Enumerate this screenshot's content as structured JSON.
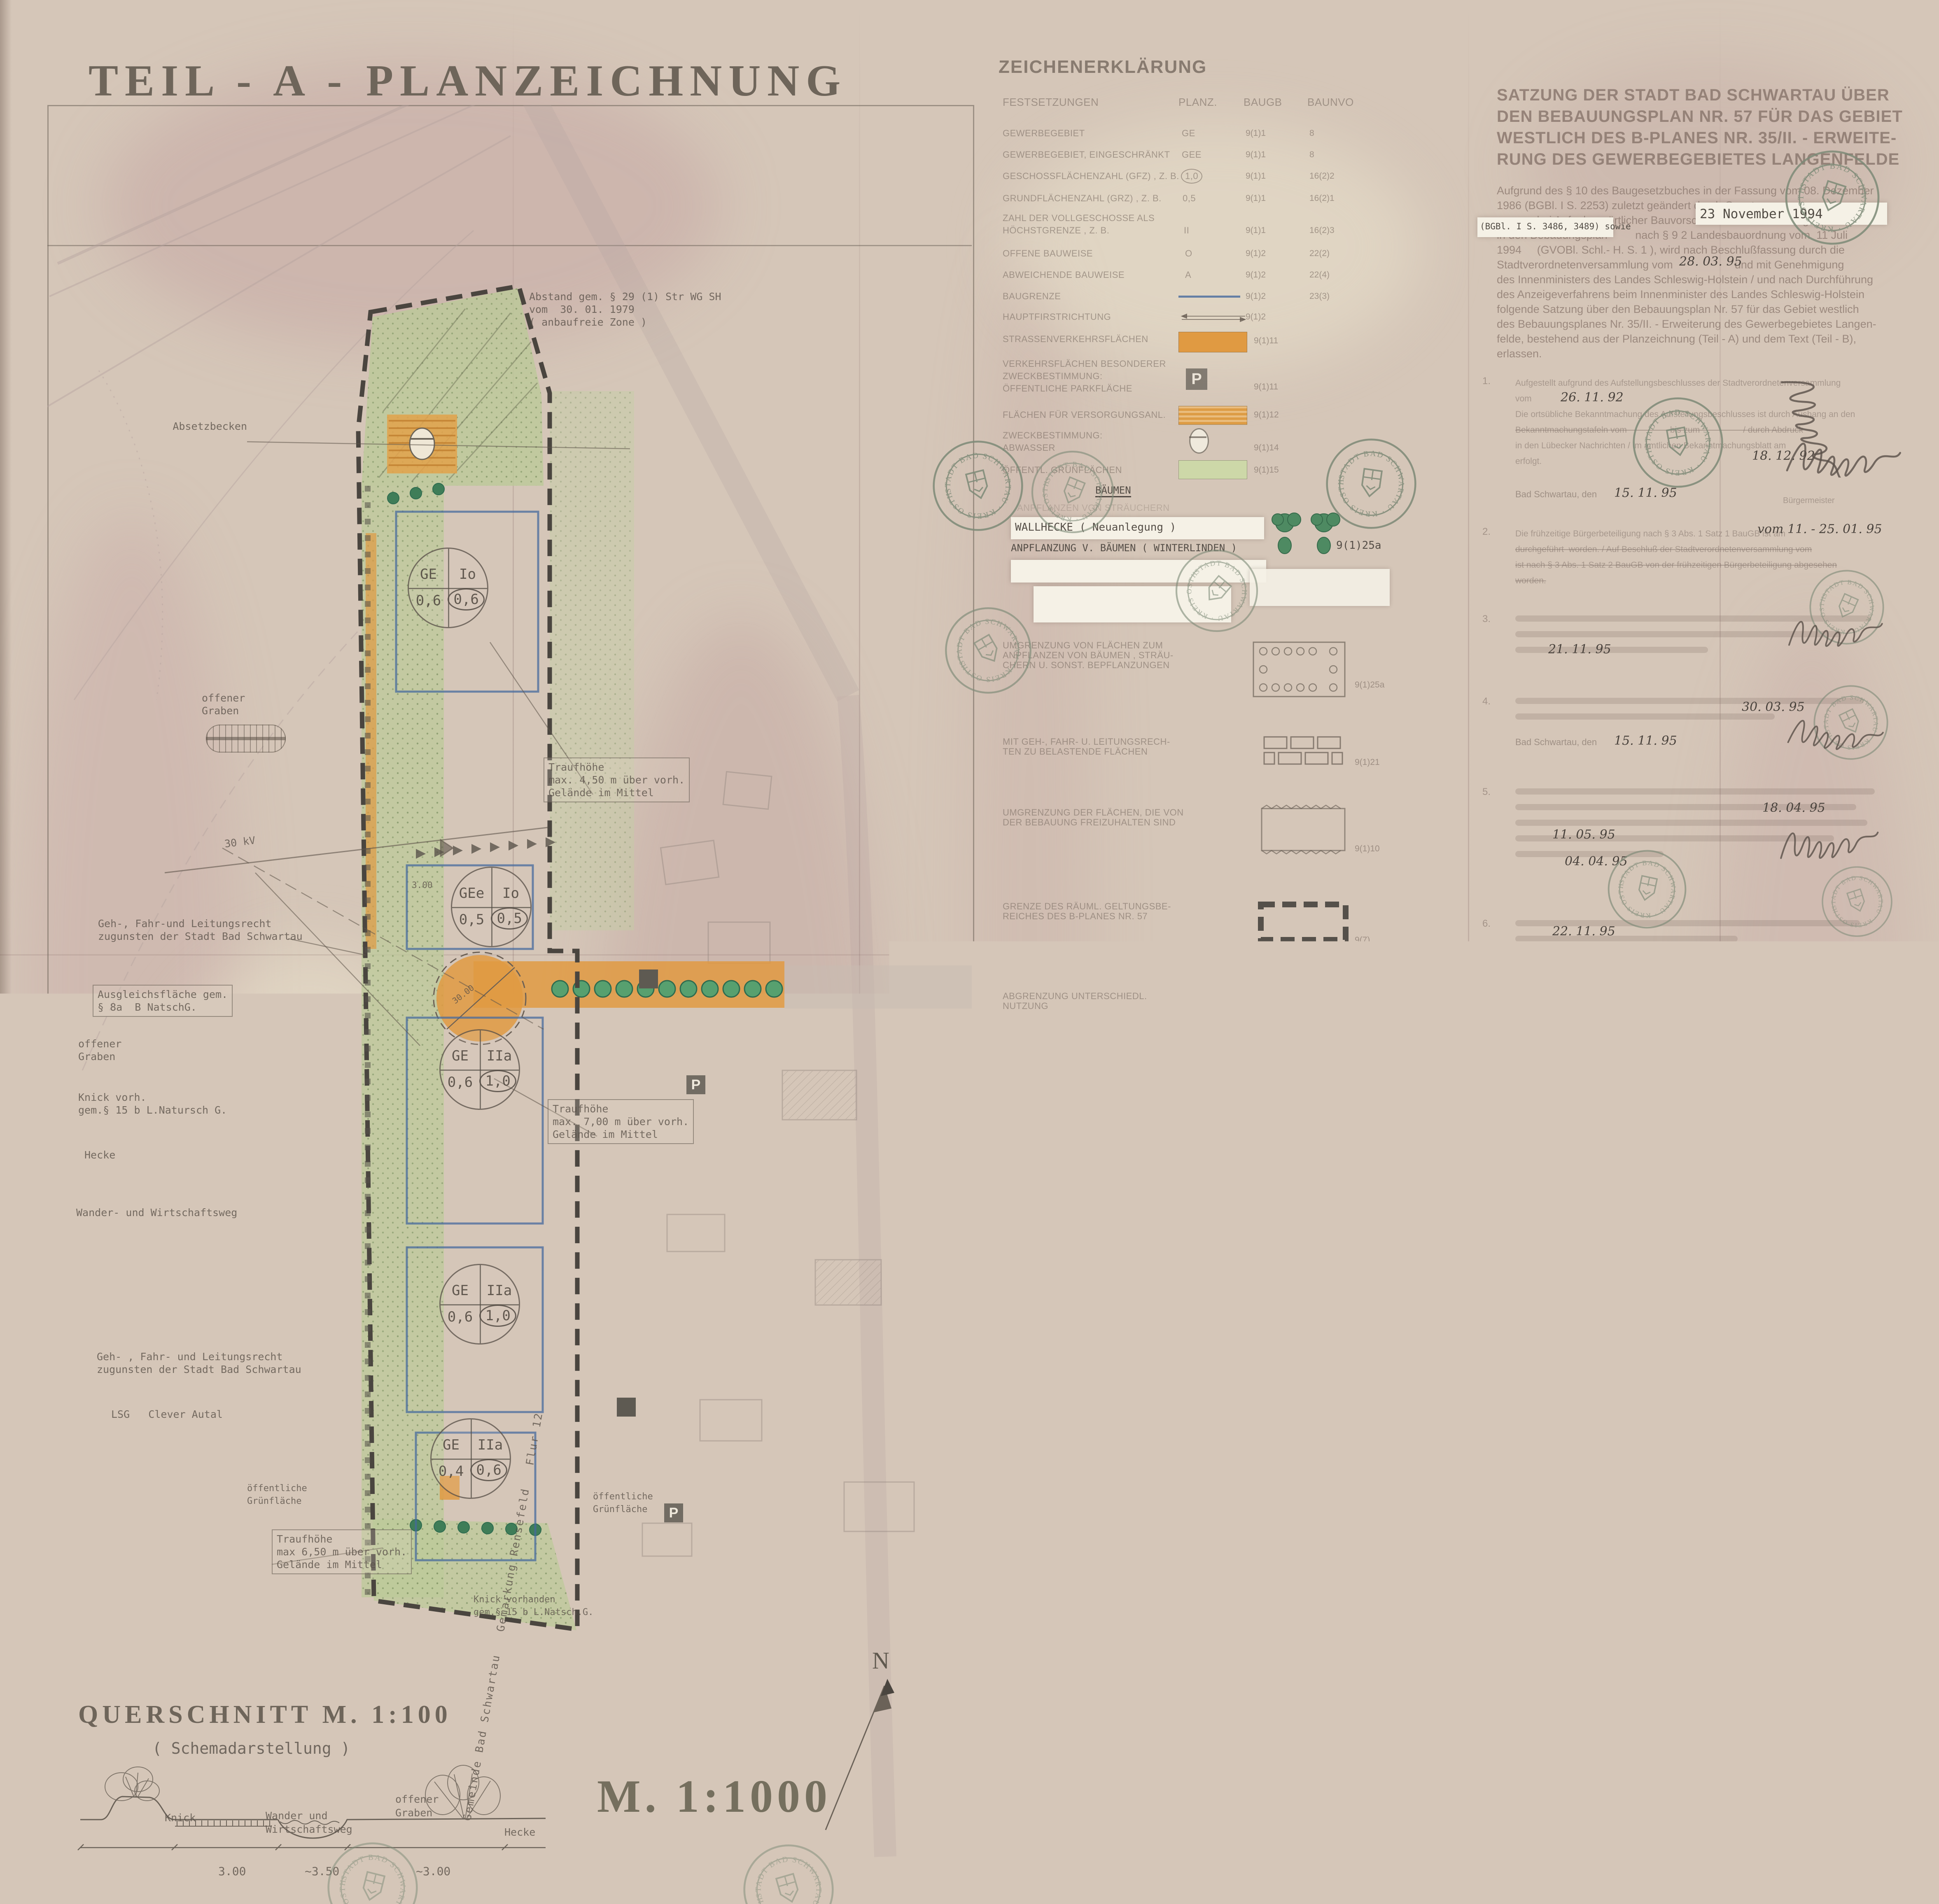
{
  "colors": {
    "paper": "#d5c6b8",
    "orange": "#e09a42",
    "green": "#b9c795",
    "blue": "#46699e",
    "dark": "#4a453f",
    "stamp_green": "#7d8a77"
  },
  "page": {
    "title": "TEIL - A - PLANZEICHNUNG"
  },
  "stamp": {
    "ring": "STADT BAD SCHWARTAU · KREIS OSTHOLSTEIN ·"
  },
  "legend": {
    "title": "ZEICHENERKLÄRUNG",
    "col_headers": {
      "festsetzungen": "FESTSETZUNGEN",
      "planz": "PLANZ.",
      "baugb": "BAUGB",
      "baunvo": "BAUNVO"
    },
    "rows": [
      {
        "label": "GEWERBEGEBIET",
        "planz": "GE",
        "baugb": "9(1)1",
        "baunvo": "8"
      },
      {
        "label": "GEWERBEGEBIET, EINGESCHRÄNKT",
        "planz": "GEe",
        "baugb": "9(1)1",
        "baunvo": "8"
      },
      {
        "label": "GESCHOSSFLÄCHENZAHL (GFZ) , z. B.",
        "planz": "1,0",
        "baugb": "9(1)1",
        "baunvo": "16(2)2"
      },
      {
        "label": "GRUNDFLÄCHENZAHL (GRZ) , z. B.",
        "planz": "0,5",
        "baugb": "9(1)1",
        "baunvo": "16(2)1"
      },
      {
        "l1": "ZAHL DER VOLLGESCHOSSE ALS",
        "l2": "HÖCHSTGRENZE , z. B.",
        "planz": "II",
        "baugb": "9(1)1",
        "baunvo": "16(2)3"
      },
      {
        "label": "OFFENE BAUWEISE",
        "planz": "o",
        "baugb": "9(1)2",
        "baunvo": "22(2)"
      },
      {
        "label": "ABWEICHENDE BAUWEISE",
        "planz": "a",
        "baugb": "9(1)2",
        "baunvo": "22(4)"
      },
      {
        "label": "BAUGRENZE",
        "baugb": "9(1)2",
        "baunvo": "23(3)"
      },
      {
        "label": "HAUPTFIRSTRICHTUNG",
        "baugb": "9(1)2",
        "baunvo": ""
      },
      {
        "label": "STRASSENVERKEHRSFLÄCHEN",
        "baugb": "9(1)11",
        "baunvo": ""
      },
      {
        "l1": "VERKEHRSFLÄCHEN BESONDERER",
        "l2": "ZWECKBESTIMMUNG:",
        "l3": "ÖFFENTLICHE PARKFLÄCHE",
        "baugb": "9(1)11",
        "baunvo": ""
      },
      {
        "label": "FLÄCHEN FÜR VERSORGUNGSANL.",
        "baugb": "9(1)12",
        "baunvo": ""
      },
      {
        "l1": "ZWECKBESTIMMUNG:",
        "l2": "ABWASSER",
        "baugb": "9(1)14",
        "baunvo": ""
      },
      {
        "label": "ÖFFENTL. GRÜNFLÄCHEN",
        "baugb": "9(1)15",
        "baunvo": ""
      }
    ],
    "baeumen_note": "BÄUMEN",
    "anpflanzen_faded": "ANPFLANZEN VON STRÄUCHERN",
    "wallhecke_label": "WALLHECKE ( Neuanlegung )",
    "anpflanzung_label": "ANPFLANZUNG V. BÄUMEN ( WINTERLINDEN )",
    "wallhecke_ref": "9(1)25a",
    "umgrenzung_anpflanzen": [
      "UMGRENZUNG VON FLÄCHEN ZUM",
      "ANPFLANZEN VON BÄUMEN , STRÄU-",
      "CHERN U. SONST. BEPFLANZUNGEN"
    ],
    "umgrenzung_anpflanzen_ref": "9(1)25a",
    "geh_fahr": [
      "MIT GEH-, FAHR- U. LEITUNGSRECH-",
      "TEN ZU BELASTENDE FLÄCHEN"
    ],
    "geh_fahr_ref": "9(1)21",
    "freizuhalten": [
      "UMGRENZUNG DER FLÄCHEN, DIE VON",
      "DER BEBAUUNG FREIZUHALTEN SIND"
    ],
    "freizuhalten_ref": "9(1)10",
    "grenze": [
      "GRENZE DES RÄUML. GELTUNGSBE-",
      "REICHES DES B-PLANES NR. 57"
    ],
    "grenze_ref": "9(7)",
    "abgrenzung": [
      "ABGRENZUNG UNTERSCHIEDL.",
      "NUTZUNG"
    ],
    "abgrenzung_ref": "16(5)+1(4)",
    "massnahmen": [
      "UMGRENZUNG VON FLÄCHEN FÜR MAßNAHMEN",
      "ZUM SCHUTZ, ZUR PFLEGE UND ZUR ENTWICKLUNG",
      "VON NATUR UND LANDSCHAFT."
    ],
    "massnahmen_ref": "9(1) 20"
  },
  "darstellungen": {
    "title": "DARSTELLUNGEN OHNE NORMCHARAKTER",
    "rows": [
      "110 KV-FREILEITUNG",
      "GRABEN",
      "QUERSCHNITT",
      "VORH. GRUNDSTÜCKSGRENZEN",
      "GEPL. GRUNDSTÜCKSGRENZEN"
    ],
    "flurstueck_label": "FLURSTÜCKSBEZEICHNUNG",
    "flurstueck_value": "952/1"
  },
  "nachrichtlich": {
    "title": "NACHRICHTLICHE ÜBERNAHMEN",
    "knick": "KNICK GEM. § 15 b L.NatschG.",
    "lsg": "LSG  Clever Autal"
  },
  "teil_b": {
    "title": "TEIL - B - TEXT",
    "s1_head": "1. ART DER BAUL. NUTZUNG (§ 9 Abs. 1 Nr. 1 BauGB)",
    "s1": [
      "Gem. § 1 Abs 5 + 9 i. V. m. § 8 BauNVO sind im eingeschränkten Gewerbegebiet GEe nur",
      "zulässig:",
      "- Lagerhäuser",
      "- Lagerplätze, außer Schrottlagerplätze",
      "- Abstell- und Ausstellungsplätze sowie -räume",
      "- Stellplätze und Garagen",
      "- sonst. Nebenanlagen",
      "Baul. Anlagen mit Aufenthaltsräumen im Sinne § 2 Abs. 5 LBO sind im GEe unzulässig."
    ],
    "s1_hand": [
      "Gem. § 1 Abs. 9 BauNVO sind Einzelhandelsbetriebe im Gewerbegebiet nicht zulässig.",
      "Sie können als Ausnahme zugelassen werden, wenn sie in unmittelbaren räumlichen und",
      "betrieblichen Zusammenhang mit einen Handwerksbetrieb oder einem produzierendem bzw.",
      "verarbeitendem Gewerbebetrieb stehen. Eigenständige Einzelhandelsbetriebe sind als Ausnahme",
      "zulässig, wenn sie ausschließlich zur Deckung des tägl. Bedarfs der Bewohner und Beschäftigten",
      "des Gebietes dienen."
    ],
    "s2_head": "2. ABWEICHENDE BAUWEISE (§ 9 Abs. 1 Nr. 2 BauGB)",
    "s2": [
      "In der abweichenden Bauweise ist eine einseitige Grenzbebauung zulässig. Dabei können die",
      "Gebäude an jeweils einer benachbarten - im Plan als \"künftig\" dargestellten - Grundstücks-",
      "grenze, abweichend von der offenen Bauweise, bis zur Hälfte der jeweiligen Grundstückstiefe",
      "ohne Grenzabstand errichtet werden."
    ],
    "s3_head": "3. STELLPLÄTZE, GARAGEN + NEBENANLAGEN (§ 9 Abs. 1 Nr. 4 BauGB)",
    "s3": [
      "Oberirdische Stellplätze und Garagen sowie Nebenanlagen sind nur innerhalb der überbauba-",
      "ren Grundstücksflächen zulässig.",
      "Unterirdische Einstellplätze sind auch außerhalb dieser Flächen zulässig, sofern die EG-Decke",
      "begrünt wird."
    ],
    "s4_head": "4. NICHT-ÜBERBAUBARE FLÄCHEN (§ 9 Abs. 1 Nr. 2+20 BauGB)",
    "s4": [
      "Alle Flächen, die nicht von baul. Anlagen im Sinne § 2 Abs. 1 LBO sowie von Wegen und",
      "Zufahrten beansprucht werden, sind als Vegetationsflächen zu gestalten."
    ],
    "s5_head": "5. HÖHE DER BAUL. ANLAGEN (§ 9 Abs. 2 BauGB)",
    "s5": [
      "Firsthöhe max. 12,00 m, gemessen jeweils über anstehendem Gelände, im Mittel."
    ],
    "s6_head": "6. ÄUSSERE GESTALTUNG DER BAUL. ANLAGEN (§ 9 Abs. 4 BauGB / § 92 LBO)",
    "s6": [
      "Dachgestaltung:",
      "Geneigtes Dach bis max. 45° Dachneigung",
      "oder Flachdach"
    ],
    "s7_head": "7. GRÜNORDNERISCHE MASSNAHMEN (§ 9 Abs. 1 Nr. 25a BauGB)",
    "s7_head_hand": "+ § 8a Abs. 1 Satz 4 BNatSchG.",
    "s7_wallhecke": "Die geplante Wallhecke",
    "s7a": [
      "ist mit folgenden Gehölzarten zu bepflanzen :",
      "Hasel, Schlehe, Hainbuche, Brombeere, Hundsrose, Pfaffenhütchen, Schneeball, Berg- und",
      "Feldahorn, Stieleiche",
      "(je 10 %)",
      "Pflanzgrößen:",
      "Bäume :  Heister, 2 x v., 125 - 150",
      "Sträucher :  Leichte Sträucher, 1 x v., 80 - 120, je nach Art"
    ],
    "s7_wall": "Wall",
    "s7b1": "Der          hat eine Breite von 2,50 m, eine Höhe von 1,00 m. Die Krone ist 1,50 m breit.",
    "s7b": [
      "- 3-reihige Heckenpflanzung mit 1-m-Reihenabstand. Innerhalb der Reihen 1 m Pflanzabstand."
    ],
    "s7_strike": "Die Pflanzung ist wirksam gegen Wildverbiß zu schützen.",
    "s7c": [
      "Pflanzenauswahl und -größen: siehe Knick",
      "- Bei gewerblich genutzten Gebäuden sind fensterlose Fassaden zu begrünen. Das gleiche gilt",
      "für Außenwandflächen mit einer Breite von mehr als 3 m zwischen Öffnungen."
    ],
    "s7_hand": [
      "Die  Fläche westlich des Wirtschaftsweges ist mit einheimischen Standortgerechten",
      "Laubgehölzen aufzuforsten. Die Pflanzen sind in einem Pflanz- u. Reihenabstand",
      "von 1,50 m  zusetzen",
      "Pflanzgröße :  Jungpflanzen bis leichte Heister,  1x verpflanzt"
    ],
    "s7d": [
      "- Zuordnung der Ausgleichs- und Ersatzmaßnahmen gem. § 8a Satz 4 BNatSchG",
      "Die Maßnahmen und Anpflanzungen gem. Pkt. 7 einschl. Herrichtung und Erwerb der Aus-",
      "gleichsfläche werden den Grundstücksflächen, auf denen der Eingriff zu erwarten ist,",
      "zugeordnet. Dies sind alle im Gewerbegebiet ausgewiesenen Baugrundstücke."
    ],
    "s8_head1": "8. Maßnahmen zum Schutz , zur Pflege und zur Entwicklung",
    "s8_head2": "von Natur und Landschaft (§ 9 Abs. 1 Nr. 20  BauGB)",
    "s8": [
      "Der Wander— und Wirtschaftsweg ist mit einer wassergebunden Decke",
      "zu versehen. Versiegelungen sind unzulässig.",
      "Dies gilt auch für die als Geh-, Fahr- u. Leitungsrecht festgesetzten Flächen."
    ]
  },
  "corrections": {
    "geaendert": [
      "Geändert gem . Erlaß des Innenministers des Landes",
      "Schleswig - Holstein vom 29 .Februar 1996",
      "Az . : IV 810  b - 512 . 113 - 55.4 (57) ."
    ],
    "entwurf": "ENTWURF"
  },
  "satzung": {
    "title": [
      "SATZUNG DER STADT BAD SCHWARTAU ÜBER",
      "DEN BEBAUUNGSPLAN NR. 57 FÜR DAS GEBIET",
      "WESTLICH DES B-PLANES NR. 35/II. - ERWEITE-",
      "RUNG DES GEWERBEGEBIETES LANGENFELDE"
    ],
    "intro": [
      "Aufgrund des § 10 des Baugesetzbuches in der Fassung vom 08. Dezember",
      "1986 (BGBl. I S. 2253) zuletzt geändert durch Gesetz vom",
      "             bei Aufnahme örtlicher Bauvorschriften als Festsetzungen",
      "in den Bebauungsplan         nach § 9 2 Landesbauordnung vom  11 Juli",
      "1994     (GVOBl. Schl.- H. S. 1 ), wird nach Beschlußfassung durch die",
      "Stadtverordnetenversammlung vom                    und mit Genehmigung",
      "des Innenministers des Landes Schleswig-Holstein / und nach Durchführung",
      "des Anzeigeverfahrens beim Innenminister des Landes Schleswig-Holstein",
      "folgende Satzung über den Bebauungsplan Nr. 57 für das Gebiet westlich",
      "des Bebauungsplanes Nr. 35/II. - Erweiterung des Gewerbegebietes Langen-",
      "felde, bestehend aus der Planzeichnung (Teil - A) und dem Text (Teil - B),",
      "erlassen."
    ],
    "datum_correction": "23 November 1994",
    "bgbl_correction": "(BGBl. I S. 3486, 3489) sowie",
    "beschluss_datum": "28. 03. 95"
  },
  "verfahren": {
    "city_label": "Bad Schwartau, den",
    "e1": {
      "num": "1.",
      "l1": "Aufgestellt aufgrund des Aufstellungsbeschlusses der Stadtverordnetenversammlung",
      "l2": "vom",
      "d1": "26. 11. 92",
      "l3": "Die ortsübliche Bekanntmachung des Aufstellungsbeschlusses ist durch Aushang an den",
      "l4": "Bekanntmachungstafeln vom                  bis zum                  / durch Abdruck",
      "l5": "in den Lübecker Nachrichten / im amtlichen Bekanntmachungsblatt am",
      "d2": "18. 12. 92",
      "l6": "erfolgt.",
      "cd": "15. 11. 95",
      "role": "Bürgermeister"
    },
    "e2": {
      "num": "2.",
      "l1": "Die frühzeitige Bürgerbeteiligung nach § 3 Abs. 1 Satz 1 BauGB ist am",
      "d1": "vom 11. - 25. 01. 95",
      "l2": "durchgeführt  worden. / Auf Beschluß der Stadtverordnetenversammlung vom",
      "l3": "ist nach § 3 Abs. 1 Satz 2 BauGB von der frühzeitigen Bürgerbeteiligung abgesehen",
      "l4": "worden."
    },
    "e3": {
      "num": "3.",
      "d1": "21. 11. 95"
    },
    "e4": {
      "num": "4.",
      "d1": "30. 03. 95",
      "cd": "15. 11. 95"
    },
    "e5": {
      "num": "5.",
      "d1": "18. 04. 95",
      "d2": "11. 05. 95",
      "d3": "04. 04. 95"
    },
    "e6": {
      "num": "6.",
      "d1": "22. 11. 95",
      "d2": "05. 01. 1995"
    },
    "e7": {
      "num": "7.",
      "d1": "05. 01. 1995",
      "d2": "16a"
    },
    "e8": {
      "num": "8.",
      "cd": "15. 11. 95"
    },
    "e9": {
      "num": "9.",
      "d1": "18. 04. 95",
      "d2": "04. 04. 95",
      "cd": "22. 11. 95"
    },
    "e10": {
      "num": "10.",
      "d1": "20. 11. 95",
      "d2": "IV 810 b - 512. 113 - 55.4 (57)",
      "d3": "28. 04. 96",
      "cd": "15. 11. 95"
    },
    "e10b": {
      "cd": "20. 05. 96"
    },
    "e11": {
      "num": "11.",
      "l1": "Die Bebauungsplansatzung, bestehend aus der Planzeichnung (Teil - A) und dem Text",
      "l2": "(Teil - B),  wird hiermit ausgefertigt.",
      "cd": "20. 05. 96",
      "org1": "Stadt Bad Schwartau",
      "org2": "Magistrat",
      "role": "Bürgermeister"
    },
    "e12": {
      "num": "12.",
      "lines": [
        "Die Durchführung des Anzeigeverfahrens zum Bebauungsplan sowie die Stelle, bei der der",
        "Plan auf Dauer während der Dienststunden von jederman eingesehen werden kann und",
        "über den Inhalt Auskunft zu erfahren ist, sind am                             (vom",
        "bis zum                    ) ortsüblich bekanntgemacht worden.  In der Bekanntmachung",
        "ist auf die Geltendmachung der Verletzung von Verfahrens- und Formvorschriften und",
        "von Mängeln der Abwägung sowie auf die Rechtsfolgen (§ 215 Abs. 2 BauGB) und",
        "weiter auf Fälligkeit und Erlöschen von Entschädigungsansprüchen (§ 44 BauGB) hinge-",
        "wiesen worden.  Die Satzung ist mithin am                      in Kraft getreten."
      ],
      "d1": "24. 05. 96",
      "d2": "25. 05. 96",
      "cd": "28. 05. 96"
    }
  },
  "footer": {
    "plan_label": "Bebauungsplan Nr. 57"
  },
  "querschnitt": {
    "title": "QUERSCHNITT   M. 1:100",
    "subtitle": "( Schemadarstellung )",
    "knick": "Knick",
    "weg1": "Wander und",
    "weg2": "Wirtschaftsweg",
    "graben1": "offener",
    "graben2": "Graben",
    "hecke": "Hecke",
    "dims": [
      "2.50",
      "3.00",
      "~3.50",
      "~3.00"
    ]
  },
  "scale": {
    "text": "M. 1:1000",
    "north": "N"
  },
  "map": {
    "absetzbecken": "Absetzbecken",
    "abstand": [
      "Abstand gem. § 29 (1) Str WG SH",
      "vom  30. 01. 1979",
      "( anbaufreie Zone )"
    ],
    "offener_graben1": "offener\nGraben",
    "offener_graben2": "offener\nGraben",
    "offener_graben3": "offener\nGraben",
    "kv": "30 kV",
    "gfl1": [
      "Geh-, Fahr-und Leitungsrecht",
      "zugunsten der Stadt Bad Schwartau"
    ],
    "ausgleich": [
      "Ausgleichsfläche gem.",
      "§ 8a  B NatschG."
    ],
    "knick_vorh": [
      "Knick vorh.",
      "gem.§ 15 b L.Natursch G."
    ],
    "hecke": "Hecke",
    "weg": "Wander- und Wirtschaftsweg",
    "gfl2": [
      "Geh- , Fahr- und Leitungsrecht",
      "zugunsten der Stadt Bad Schwartau"
    ],
    "lsg": "LSG   Clever Autal",
    "trauf1": [
      "Traufhöhe",
      "max. 4,50 m über vorh.",
      "Gelände im Mittel"
    ],
    "trauf2": [
      "Traufhöhe",
      "max. 7,00 m über vorh.",
      "Gelände im Mittel"
    ],
    "trauf3": [
      "Traufhöhe",
      "max 6,50 m über vorh.",
      "Gelände im Mittel"
    ],
    "gruen1": "öffentliche\nGrünfläche",
    "gruen2": "öffentliche\nGrünfläche",
    "knick_vorhanden": [
      "Knick vorhanden",
      "gem.§ 15 b L.Natsch.G."
    ],
    "gemeinde": "Gemeinde Bad Schwartau   Gemarkung Rensefeld   Flur 12",
    "dim_300": "3.00",
    "dim_3000": "30.00",
    "p": "P",
    "schab": [
      {
        "tl": "GE",
        "tr": "Io",
        "bl": "0,6",
        "br": "0,6"
      },
      {
        "tl": "GEe",
        "tr": "Io",
        "bl": "0,5",
        "br": "0,5"
      },
      {
        "tl": "GE",
        "tr": "IIa",
        "bl": "0,6",
        "br": "1,0"
      },
      {
        "tl": "GE",
        "tr": "IIa",
        "bl": "0,6",
        "br": "1,0"
      },
      {
        "tl": "GE",
        "tr": "IIa",
        "bl": "0,4",
        "br": "0,6"
      }
    ]
  }
}
